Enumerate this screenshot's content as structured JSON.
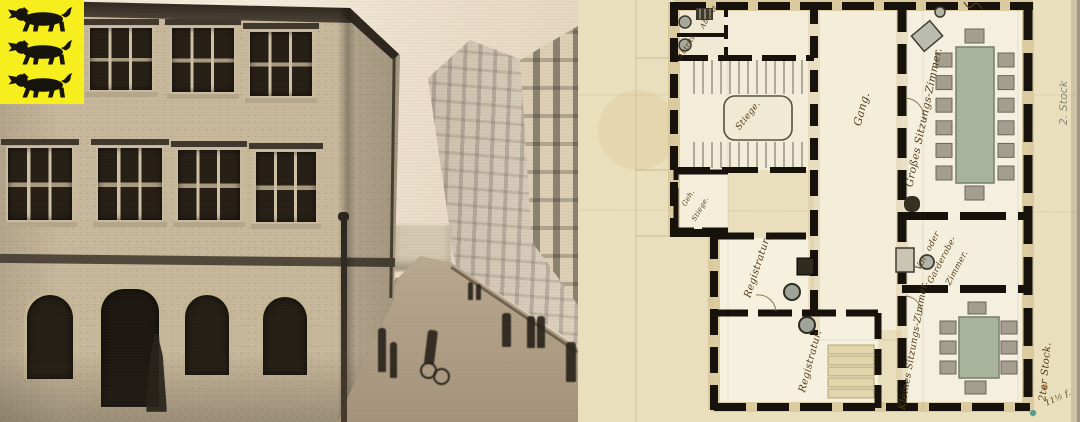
{
  "flag": {
    "name": "three-lions-arms",
    "lion_count": 3
  },
  "colors": {
    "flag_yellow": "#f6ee1d",
    "lion_black": "#17140d",
    "paper_beige": "#e9dfbc",
    "wall_black": "#17130c",
    "ink_brown": "#533c18",
    "pencil_gray": "#8d897c",
    "table_green": "#a9b39c",
    "chair_gray": "#a49e8e",
    "sill_tan": "#d9c89b"
  },
  "plan": {
    "labels": {
      "abtritt1": "Abtritt.",
      "abtritt2": "Abtritt.",
      "stiege": "Stiege.",
      "geh_stiege_line1": "Geh.",
      "geh_stiege_line2": "Stiege.",
      "gang": "Gang.",
      "registratur1": "Registratur.",
      "registratur2": "Registratur.",
      "grosses_sitzungszimmer": "Großes Sitzungs-Zimmer.",
      "garderobe_line1": "Vor- oder",
      "garderobe_line2": "Garderobe-",
      "garderobe_line3": "Zimmer.",
      "kleines_sitzungszimmer": "Kleines Sitzungs-Zimmer."
    },
    "annotations": {
      "floor_pencil": "2. Stock",
      "floor_ink": "2ter Stock.",
      "measure_ink": "11½ f."
    },
    "furniture": {
      "large_table_side_chairs": 6,
      "large_table_end_chairs": 2,
      "small_table_side_chairs": 3,
      "small_table_end_chairs": 2
    }
  }
}
